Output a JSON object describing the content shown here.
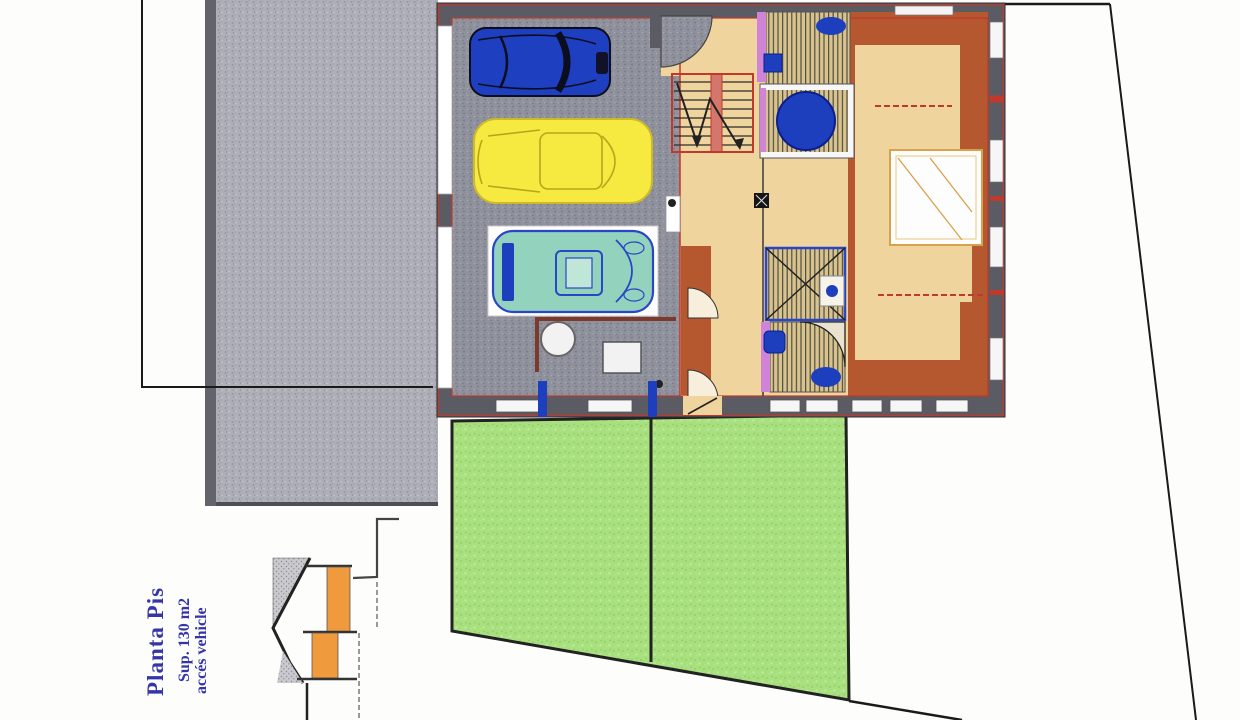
{
  "annotation": {
    "title": "Planta Pis",
    "line2": "Sup. 130 m2",
    "line3": "accés vehicle"
  },
  "palette": {
    "paper": "#fdfdfc",
    "driveway_gray": "#aeafb7",
    "garage_floor": "#8f919c",
    "wall_dark": "#5a5b63",
    "wall_accent_red": "#c0392b",
    "floor_tan": "#f0d49e",
    "terracotta": "#b5572f",
    "lawn_green": "#a9e07f",
    "fixture_blue": "#1d3fbe",
    "door_purple": "#cf84d8",
    "car_blue": "#1e3fc0",
    "car_yellow": "#f6e93f",
    "car_teal": "#93d2bc",
    "section_orange": "#f09a3e",
    "tile_stripe": "#d9c38d",
    "text_blue": "#3535a8",
    "boundary_black": "#1a1a1a"
  },
  "scene": {
    "type": "architectural floor plan",
    "rooms": [
      "garage",
      "entry-hall",
      "staircase",
      "corridor",
      "bathroom-top",
      "jacuzzi-room",
      "bathroom-lower",
      "shower-room",
      "bedroom"
    ],
    "vehicles": [
      "blue-car",
      "yellow-car",
      "teal-sports-car"
    ],
    "fixtures": [
      "toilet",
      "sink",
      "jacuzzi-tub",
      "boiler",
      "shower"
    ],
    "site": [
      "driveway",
      "lawn",
      "plot-boundary",
      "access-ramp-section-detail"
    ]
  }
}
